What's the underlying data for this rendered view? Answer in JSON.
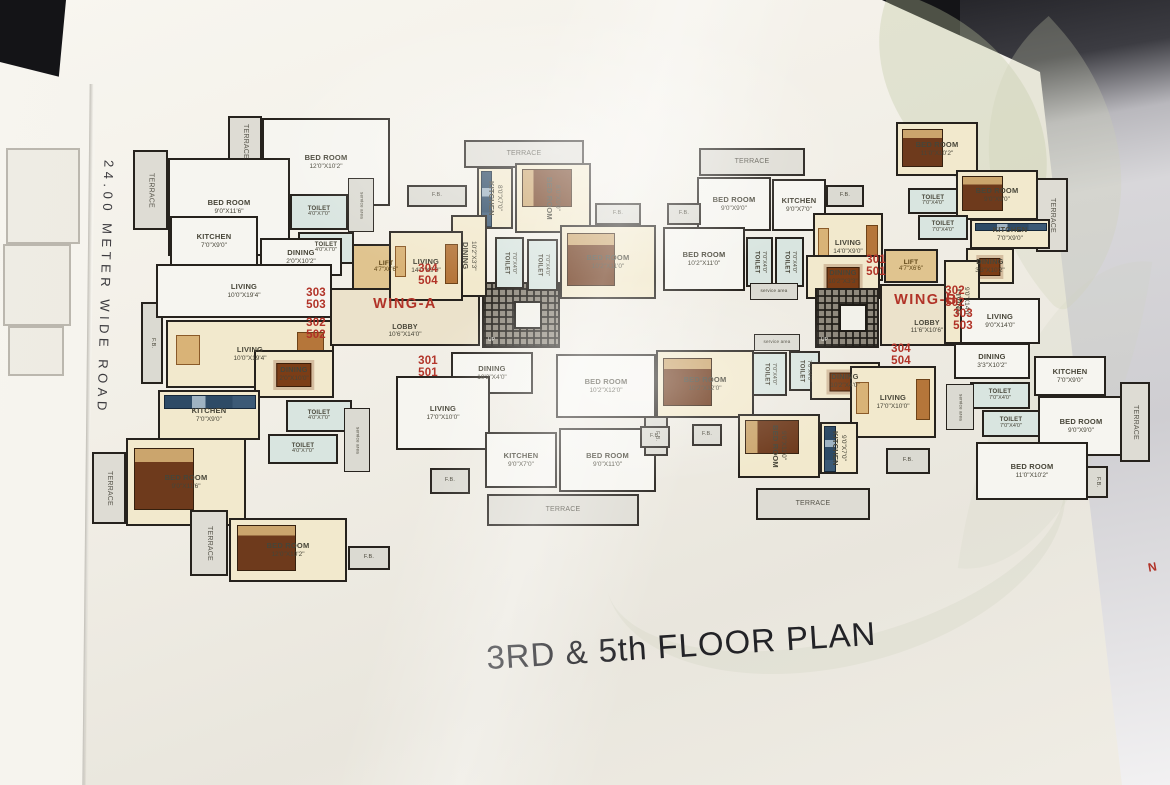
{
  "scene": {
    "title": "3RD & 5th FLOOR PLAN",
    "road_label": "24.00 METER WIDE ROAD",
    "north_marker": "N"
  },
  "colors": {
    "accent_red": "#b13227",
    "page_background": "#f2efe7",
    "wall": "#26221d",
    "room_cream": "#f2e9cd",
    "room_white": "#f6f5f0",
    "terrace_gray": "#dedcd4",
    "toilet_green": "#d9e5e0",
    "lift_tan": "#e0c48f",
    "watermark_leaf": "#becaa2"
  },
  "wings": [
    {
      "name": "WING-A",
      "lobby_dims": "10'6\"X14'0\"",
      "lift_dims": "4'7\"X6'6\"",
      "flat_numbers": [
        "303/503",
        "302/502",
        "304/504",
        "301/501"
      ]
    },
    {
      "name": "WING-B",
      "lobby_dims": "11'6\"X10'6\"",
      "lift_dims": "4'7\"X6'6\"",
      "flat_numbers": [
        "301/501",
        "302/502",
        "303/503",
        "304/504"
      ]
    }
  ],
  "rooms": [
    {
      "label": "TERRACE"
    },
    {
      "label": "BED ROOM",
      "dims": "12'0\"X10'2\""
    },
    {
      "label": "TERRACE"
    },
    {
      "label": "BED ROOM",
      "dims": "9'0\"X11'6\""
    },
    {
      "label": "TOILET",
      "dims": "4'0\"X7'0\""
    },
    {
      "label": "service area"
    },
    {
      "label": "TOILET",
      "dims": "4'0\"X7'0\""
    },
    {
      "label": "KITCHEN",
      "dims": "7'0\"X9'0\""
    },
    {
      "label": "DINING",
      "dims": "2'0\"X10'2\""
    },
    {
      "label": "F.B."
    },
    {
      "label": "LIVING",
      "dims": "10'0\"X19'4\""
    },
    {
      "label": "303\n503"
    },
    {
      "label": "302\n502"
    },
    {
      "label": "LIVING",
      "dims": "10'0\"X19'4\""
    },
    {
      "label": "DINING",
      "dims": "2'0\"X10'0\""
    },
    {
      "label": "KITCHEN",
      "dims": "7'0\"X9'0\""
    },
    {
      "label": "TOILET",
      "dims": "4'0\"X7'0\""
    },
    {
      "label": "TOILET",
      "dims": "4'0\"X7'0\""
    },
    {
      "label": "service area"
    },
    {
      "label": "TERRACE"
    },
    {
      "label": "BED ROOM",
      "dims": "9'0\"X11'6\""
    },
    {
      "label": "TERRACE"
    },
    {
      "label": "BED ROOM",
      "dims": "12'0\"X10'2\""
    },
    {
      "label": "F.B."
    },
    {
      "label": "LIFT",
      "dims": "4'7\"X6'6\""
    },
    {
      "label": "WING-A"
    },
    {
      "label": "LOBBY",
      "dims": "10'6\"X14'0\""
    },
    {
      "label": "UP"
    },
    {
      "label": "304\n504"
    },
    {
      "label": "301\n501"
    },
    {
      "label": "TERRACE"
    },
    {
      "label": "F.B."
    },
    {
      "label": "KITCHEN",
      "dims": "8'0\"X7'0\""
    },
    {
      "label": "BED ROOM",
      "dims": "8'0\"X9'0\""
    },
    {
      "label": "F.B."
    },
    {
      "label": "DINING",
      "dims": "10'2\"X3'3\""
    },
    {
      "label": "LIVING",
      "dims": "14'0\"X9'0\""
    },
    {
      "label": "TOILET",
      "dims": "7'0\"X4'0\""
    },
    {
      "label": "TOILET",
      "dims": "7'0\"X4'0\""
    },
    {
      "label": "BED ROOM",
      "dims": "10'2\"X11'0\""
    },
    {
      "label": "DINING",
      "dims": "10'2\"X4'0\""
    },
    {
      "label": "BED ROOM",
      "dims": "10'2\"X12'0\""
    },
    {
      "label": "LIVING",
      "dims": "17'0\"X10'0\""
    },
    {
      "label": "KITCHEN",
      "dims": "9'0\"X7'0\""
    },
    {
      "label": "BED ROOM",
      "dims": "9'0\"X11'0\""
    },
    {
      "label": "F.B."
    },
    {
      "label": "F.B."
    },
    {
      "label": "TERRACE"
    },
    {
      "label": "TERRACE"
    },
    {
      "label": "BED ROOM",
      "dims": "9'0\"X9'0\""
    },
    {
      "label": "KITCHEN",
      "dims": "9'0\"X7'0\""
    },
    {
      "label": "F.B."
    },
    {
      "label": "F.B."
    },
    {
      "label": "BED ROOM",
      "dims": "10'2\"X11'0\""
    },
    {
      "label": "TOILET",
      "dims": "7'0\"X4'0\""
    },
    {
      "label": "TOILET",
      "dims": "7'0\"X4'0\""
    },
    {
      "label": "LIVING",
      "dims": "14'0\"X9'0\""
    },
    {
      "label": "DINING",
      "dims": "10'2\"X3'3\""
    },
    {
      "label": "301\n501"
    },
    {
      "label": "service area"
    },
    {
      "label": "UP"
    },
    {
      "label": "LIFT",
      "dims": "4'7\"X6'6\""
    },
    {
      "label": "WING-B"
    },
    {
      "label": "LOBBY",
      "dims": "11'6\"X10'6\""
    },
    {
      "label": "302\n502"
    },
    {
      "label": "303\n503"
    },
    {
      "label": "304\n504"
    },
    {
      "label": "BED ROOM",
      "dims": "11'0\"X10'2\""
    },
    {
      "label": "TERRACE"
    },
    {
      "label": "BED ROOM",
      "dims": "9'0\"X9'0\""
    },
    {
      "label": "KITCHEN",
      "dims": "7'0\"X9'0\""
    },
    {
      "label": "TOILET",
      "dims": "7'0\"X4'0\""
    },
    {
      "label": "TOILET",
      "dims": "7'0\"X4'0\""
    },
    {
      "label": "DINING",
      "dims": "3'3\"X10'2\""
    },
    {
      "label": "LIVING",
      "dims": "9'0\"X14'0\""
    },
    {
      "label": "LIVING",
      "dims": "9'0\"X14'0\""
    },
    {
      "label": "DINING",
      "dims": "3'3\"X10'2\""
    },
    {
      "label": "KITCHEN",
      "dims": "7'0\"X9'0\""
    },
    {
      "label": "TOILET",
      "dims": "7'0\"X4'0\""
    },
    {
      "label": "TOILET",
      "dims": "7'0\"X4'0\""
    },
    {
      "label": "service area"
    },
    {
      "label": "BED ROOM",
      "dims": "9'0\"X9'0\""
    },
    {
      "label": "BED ROOM",
      "dims": "11'0\"X10'2\""
    },
    {
      "label": "TERRACE"
    },
    {
      "label": "F.B."
    },
    {
      "label": "BED ROOM",
      "dims": "10'2\"X12'0\""
    },
    {
      "label": "service area"
    },
    {
      "label": "TOILET",
      "dims": "7'0\"X4'0\""
    },
    {
      "label": "TOILET",
      "dims": "7'0\"X4'0\""
    },
    {
      "label": "DINING",
      "dims": "10'2\"X4'0\""
    },
    {
      "label": "LIVING",
      "dims": "17'0\"X10'0\""
    },
    {
      "label": "BED ROOM",
      "dims": "9'0\"X11'0\""
    },
    {
      "label": "KITCHEN",
      "dims": "9'0\"X7'0\""
    },
    {
      "label": "F.B."
    },
    {
      "label": "TERRACE"
    },
    {
      "label": "F.B."
    },
    {
      "label": "F.B."
    }
  ]
}
